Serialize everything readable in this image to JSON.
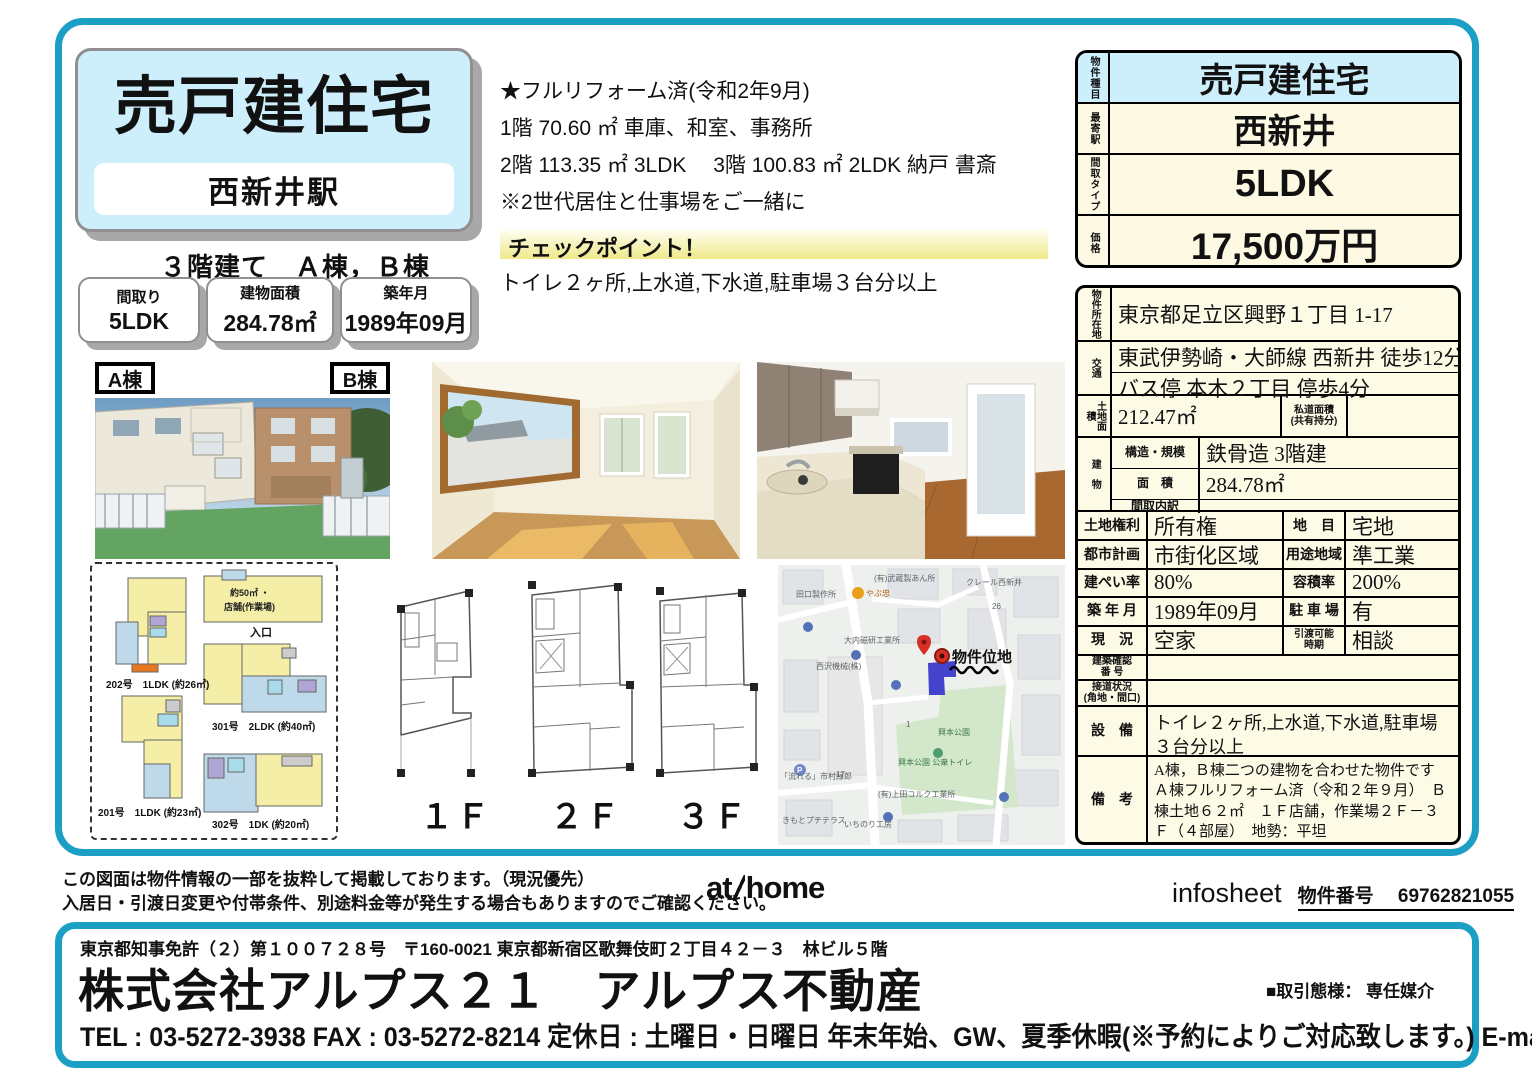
{
  "header": {
    "title": "売戸建住宅",
    "station": "西新井駅",
    "subtitle": "３階建て　Ａ棟，Ｂ棟",
    "spec_boxes": [
      {
        "label": "間取り",
        "value": "5LDK"
      },
      {
        "label": "建物面積",
        "value": "284.78㎡"
      },
      {
        "label": "築年月",
        "value": "1989年09月"
      }
    ]
  },
  "features": {
    "lines": [
      "★フルリフォーム済(令和2年9月)",
      "1階 70.60 ㎡ 車庫、和室、事務所",
      "2階 113.35 ㎡ 3LDK　 3階 100.83 ㎡ 2LDK 納戸 書斎",
      "※2世代居住と仕事場をご一緒に"
    ],
    "checkpoint_title": "チェックポイント！",
    "checkpoint_body": "トイレ２ヶ所,上水道,下水道,駐車場３台分以上"
  },
  "price_table": {
    "rows": [
      {
        "label": "物件種目",
        "value": "売戸建住宅"
      },
      {
        "label": "最寄駅",
        "value": "西新井"
      },
      {
        "label": "間取タイプ",
        "value": "5LDK"
      },
      {
        "label": "価格",
        "value": "17,500万円"
      }
    ]
  },
  "detail": {
    "location_label": "物件所在地",
    "location": "東京都足立区興野１丁目 1-17",
    "access_label": "交通",
    "access1": "東武伊勢崎・大師線 西新井 徒歩12分",
    "access2": "バス停 本木２丁目 停歩4分",
    "land_label": "土地面積",
    "land_area": "212.47㎡",
    "private_road_label1": "私道面積",
    "private_road_label2": "(共有持分)",
    "private_road_value": "",
    "building_label": "建　物",
    "structure_label": "構造・規模",
    "structure": "鉄骨造 3階建",
    "area_label": "面　積",
    "area": "284.78㎡",
    "layout_label": "間取内訳",
    "layout": "",
    "land_rights_label": "土地権利",
    "land_rights": "所有権",
    "chimoku_label": "地　目",
    "chimoku": "宅地",
    "city_plan_label": "都市計画",
    "city_plan": "市街化区域",
    "use_area_label": "用途地域",
    "use_area": "準工業",
    "coverage_label": "建ぺい率",
    "coverage": "80%",
    "far_label": "容積率",
    "far": "200%",
    "built_label": "築 年 月",
    "built": "1989年09月",
    "parking_label": "駐 車 場",
    "parking": "有",
    "status_label": "現　況",
    "status": "空家",
    "handover_label1": "引渡可能",
    "handover_label2": "時期",
    "handover": "相談",
    "confirm_label1": "建築確認",
    "confirm_label2": "番 号",
    "confirm": "",
    "road_label1": "接道状況",
    "road_label2": "(角地・間口)",
    "road": "",
    "equipment_label": "設　備",
    "equipment": "トイレ２ヶ所,上水道,下水道,駐車場３台分以上",
    "remarks_label": "備　考",
    "remarks": "A棟，Ｂ棟二つの建物を合わせた物件です Ａ棟フルリフォーム済（令和２年９月）　Ｂ棟土地６２㎡　１Ｆ店舗，作業場２Ｆ－３Ｆ（４部屋）　地勢：平坦"
  },
  "photos": {
    "labelA": "A棟",
    "labelB": "B棟"
  },
  "unit_plans": {
    "shop_caption1": "約50㎡ ・",
    "shop_caption2": "店舗(作業場)",
    "entrance": "入口",
    "unit202": "202号　1LDK (約26㎡)",
    "unit301": "301号　2LDK (約40㎡)",
    "unit201": "201号　1LDK (約23㎡)",
    "unit302": "302号　1DK (約20㎡)"
  },
  "floors": {
    "f1": "１Ｆ",
    "f2": "２Ｆ",
    "f3": "３Ｆ"
  },
  "map": {
    "property_label": "物件位地",
    "labels": [
      "(有)武蔵製あん所",
      "田口製作所",
      "やぶ忠",
      "クレール西新井",
      "大内磁研工業所",
      "西沢機械(株)",
      "興本公園",
      "興本公園 公衆トイレ",
      "(有)上田コルク工業所",
      "いちのり工房",
      "きもとプチテラス",
      "「流れる」市村緑郎",
      "26",
      "17",
      "1"
    ]
  },
  "footer": {
    "disclaimer1": "この図面は物件情報の一部を抜粋して掲載しております。（現況優先）",
    "disclaimer2": "入居日・引渡日変更や付帯条件、別途料金等が発生する場合もありますのでご確認ください。",
    "logo_at": "at",
    "logo_home": "home",
    "infosheet": "infosheet",
    "property_no": "物件番号　 69762821055"
  },
  "company": {
    "license": "東京都知事免許（２）第１００７２８号　〒160-0021 東京都新宿区歌舞伎町２丁目４２－３　林ビル５階",
    "name": "株式会社アルプス２１　アルプス不動産",
    "transaction": "■取引態様： 専任媒介",
    "contact": "TEL : 03-5272-3938  FAX : 03-5272-8214  定休日 : 土曜日・日曜日 年末年始、GW、夏季休暇(※予約によりご対応致します。)  E-mail : info@alps21.co.jp"
  },
  "colors": {
    "accent": "#1b9fc4",
    "light_blue": "#cdeefb",
    "cream": "#fdfae6"
  }
}
